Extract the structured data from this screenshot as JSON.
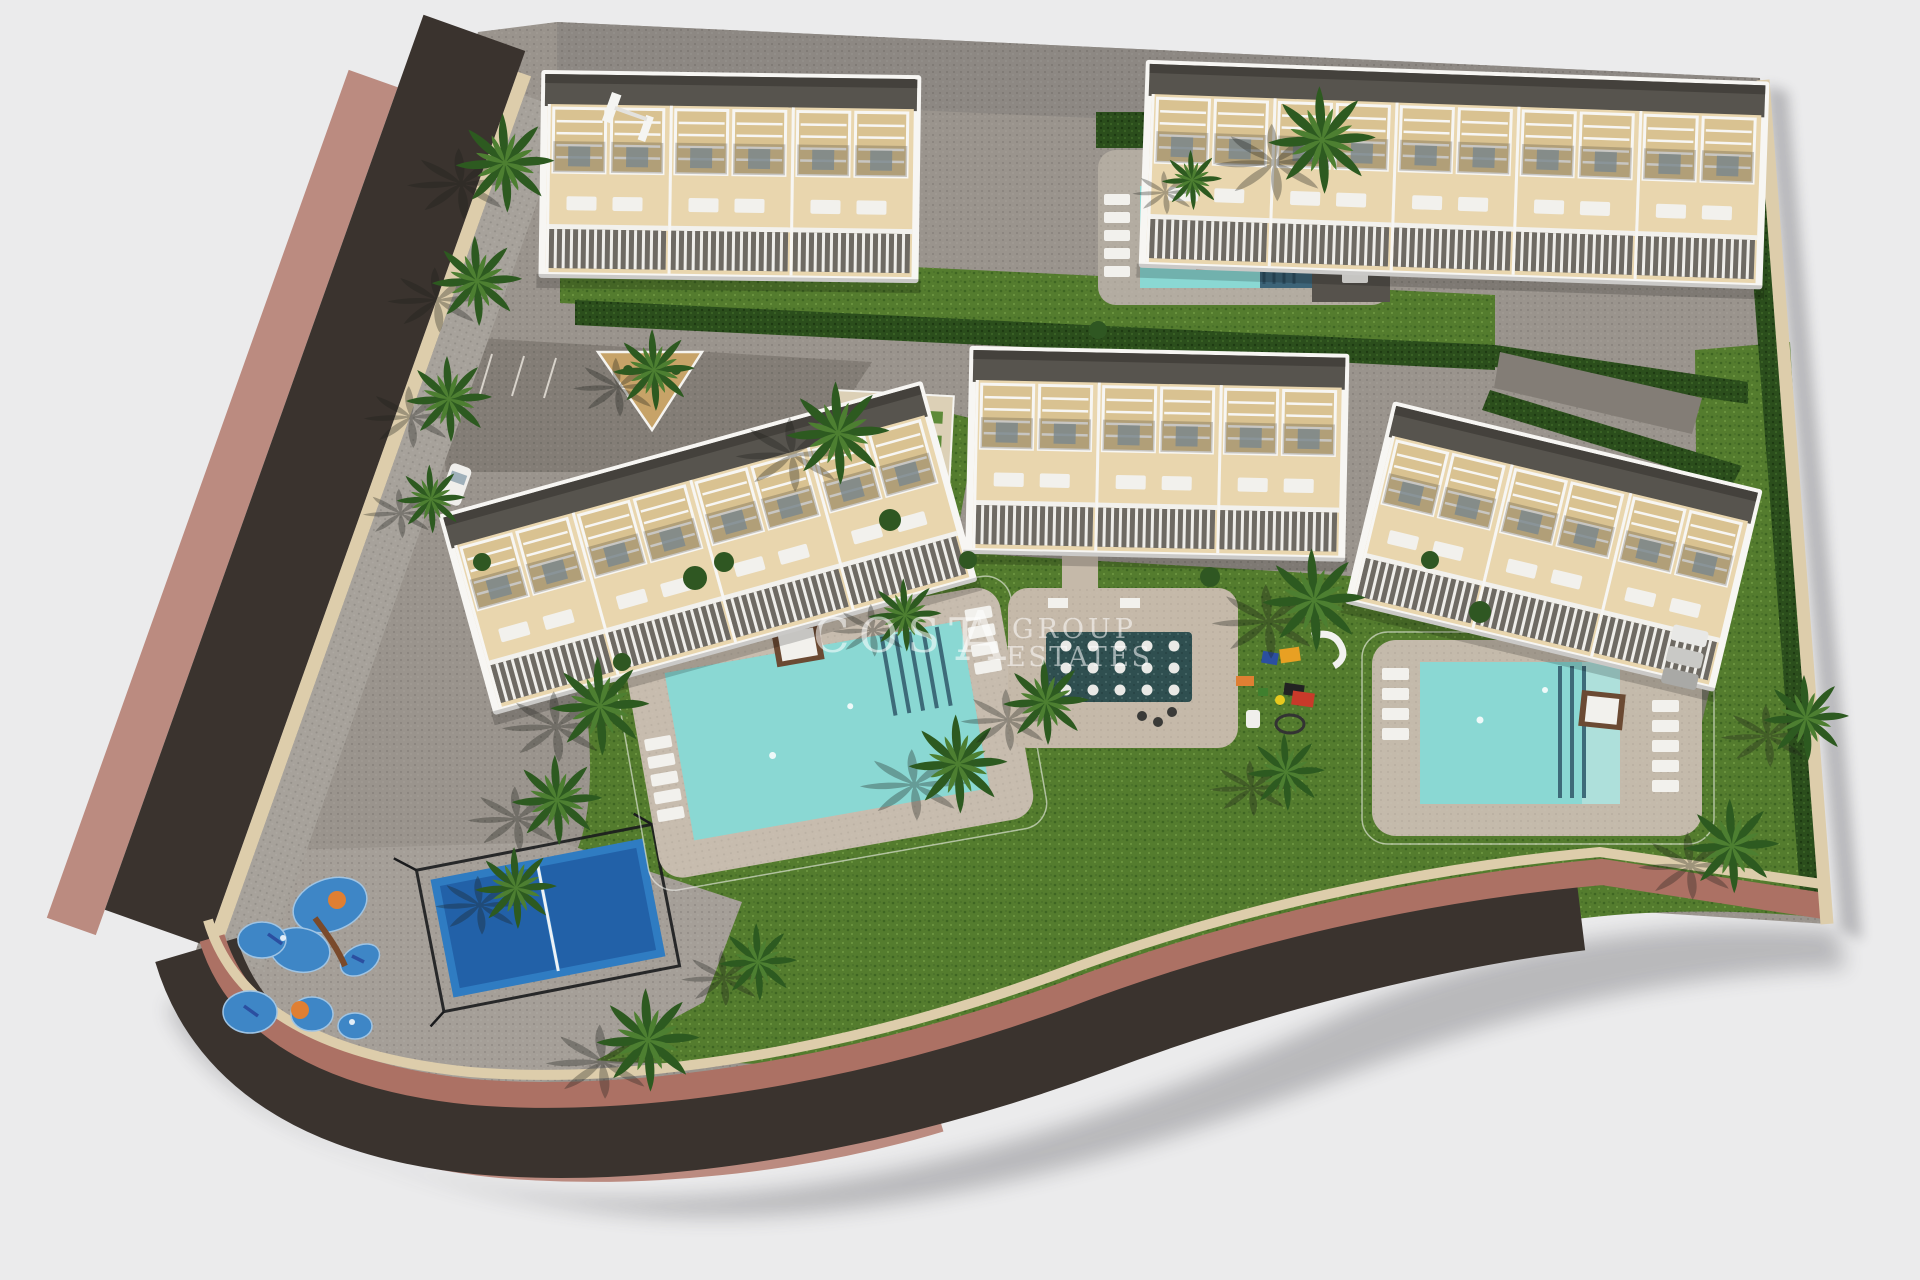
{
  "scene": {
    "description": "Aerial 3D architectural render of a coastal residential development site plan on a white background",
    "residential_blocks": 5,
    "townhouse_units": 18,
    "swimming_pools": 3,
    "reflecting_pool_with_stepping_stones": 1,
    "padel_court": 1,
    "children_playgrounds": 2,
    "parking_areas": 2,
    "palm_trees": 20,
    "cars": 4
  },
  "watermark": {
    "brand": "COSTA",
    "brand_prefix": "COST",
    "brand_monogram": "A",
    "line2": "GROUP",
    "line3": "ESTATES"
  },
  "palette": {
    "background": "#ebebec",
    "road": "#3a332e",
    "sidewalk": "#ac7164",
    "sidewalk_outer": "#bb8b80",
    "curb": "#ddcdab",
    "paving": "#9a948d",
    "paving_dark": "#837d76",
    "grass": "#547c2e",
    "hedge": "#2b4e1c",
    "pool_water": "#8ad8d3",
    "pool_dark": "#3d6478",
    "pond": "#2f4f50",
    "court_blue": "#2f7cc2",
    "court_blue_dark": "#2261a8",
    "splash_blue": "#3e86c6",
    "terrace_beige": "#e9d6ae",
    "roof_gray": "#57544e",
    "white_trim": "#f7f6f3"
  }
}
